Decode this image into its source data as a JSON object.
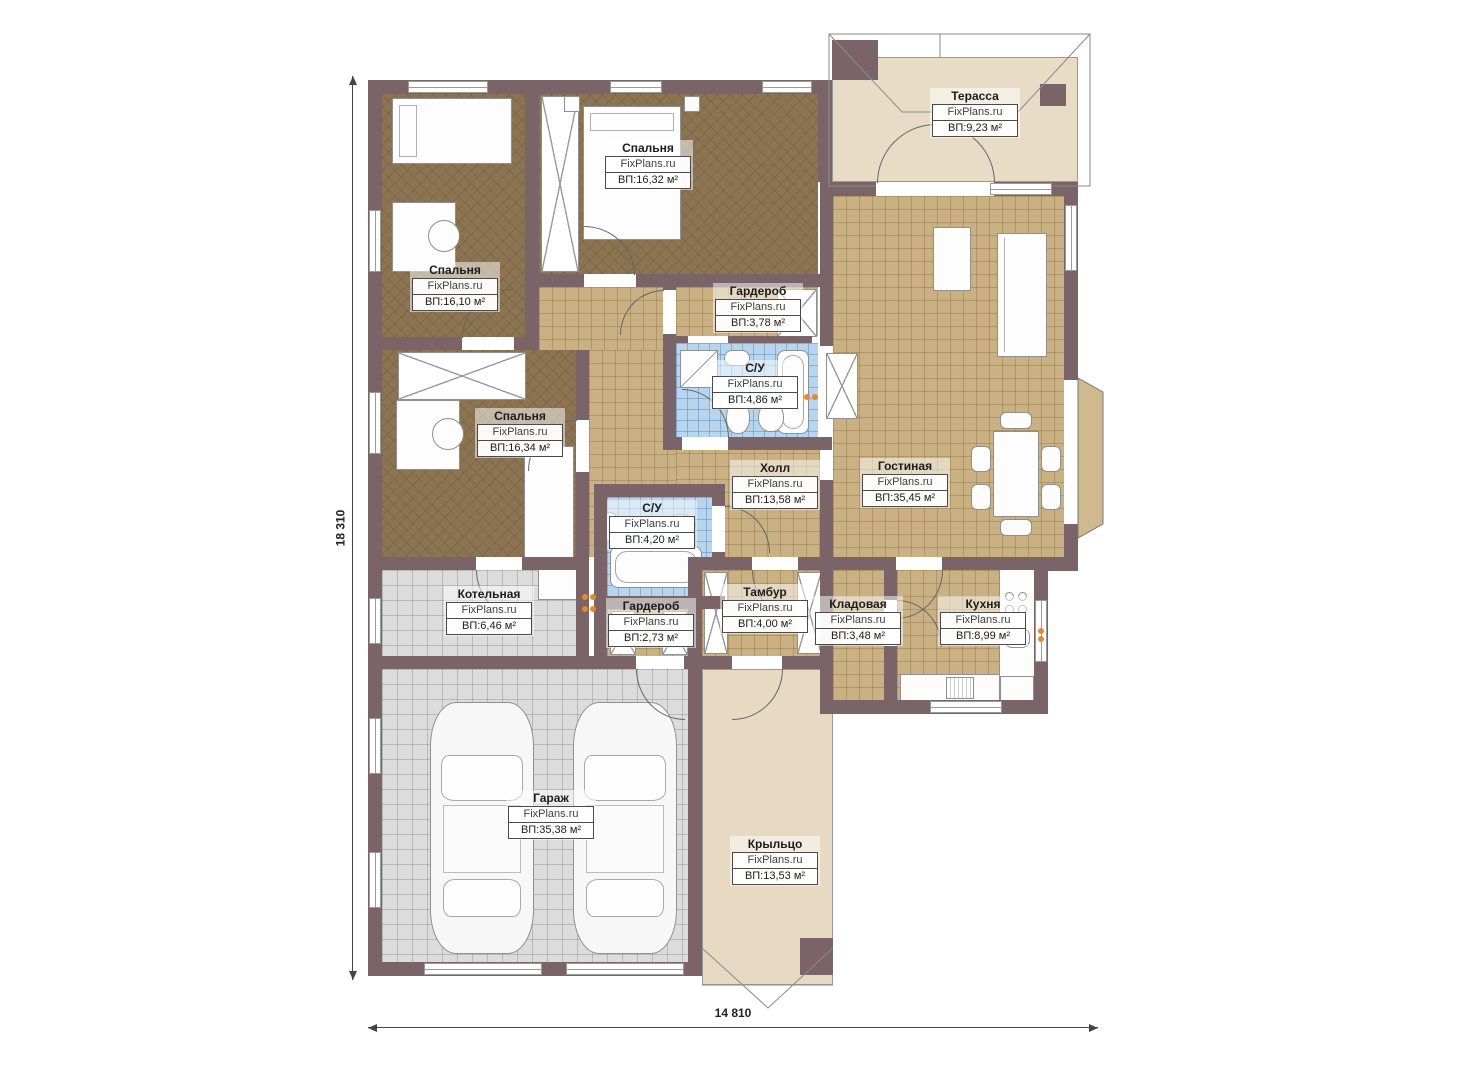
{
  "plan": {
    "watermark": "FixPlans.ru",
    "dimensions": {
      "height_label": "18 310",
      "width_label": "14 810"
    },
    "palette": {
      "wall": "#7a6468",
      "wood_floor": "#8c7453",
      "tile_tan": "#c9b183",
      "tile_blue": "#b7d5ee",
      "tile_gray": "#dcdcdc",
      "terrace_beige": "#e9dcc6",
      "socket_accent": "#e5892f"
    },
    "rooms": [
      {
        "id": "terrace",
        "name": "Терасса",
        "area": "ВП:9,23 м²"
      },
      {
        "id": "bedroom-top",
        "name": "Спальня",
        "area": "ВП:16,32 м²"
      },
      {
        "id": "bedroom-left",
        "name": "Спальня",
        "area": "ВП:16,10 м²"
      },
      {
        "id": "bedroom-lower",
        "name": "Спальня",
        "area": "ВП:16,34 м²"
      },
      {
        "id": "wardrobe-top",
        "name": "Гардероб",
        "area": "ВП:3,78 м²"
      },
      {
        "id": "bathroom-top",
        "name": "С/У",
        "area": "ВП:4,86 м²"
      },
      {
        "id": "hall",
        "name": "Холл",
        "area": "ВП:13,58 м²"
      },
      {
        "id": "living-room",
        "name": "Гостиная",
        "area": "ВП:35,45 м²"
      },
      {
        "id": "bathroom-lower",
        "name": "С/У",
        "area": "ВП:4,20 м²"
      },
      {
        "id": "boiler-room",
        "name": "Котельная",
        "area": "ВП:6,46 м²"
      },
      {
        "id": "wardrobe-lower",
        "name": "Гардероб",
        "area": "ВП:2,73 м²"
      },
      {
        "id": "vestibule",
        "name": "Тамбур",
        "area": "ВП:4,00 м²"
      },
      {
        "id": "storage",
        "name": "Кладовая",
        "area": "ВП:3,48 м²"
      },
      {
        "id": "kitchen",
        "name": "Кухня",
        "area": "ВП:8,99 м²"
      },
      {
        "id": "garage",
        "name": "Гараж",
        "area": "ВП:35,38 м²"
      },
      {
        "id": "porch",
        "name": "Крыльцо",
        "area": "ВП:13,53 м²"
      }
    ]
  }
}
